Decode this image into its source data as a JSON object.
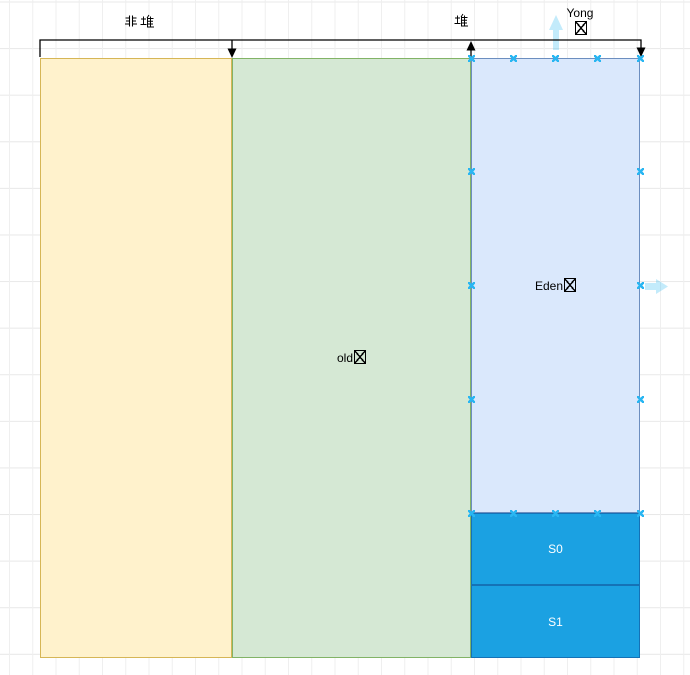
{
  "bracket": {
    "non_heap_label": "非堆",
    "heap_label": "堆",
    "young_label": "Yong区"
  },
  "regions": {
    "non_heap": {
      "fill": "#FFF2CC",
      "border": "#D6B656"
    },
    "old": {
      "label": "old区",
      "fill": "#D5E8D4",
      "border": "#82B366"
    },
    "eden": {
      "label": "Eden区",
      "fill": "#DAE8FC",
      "border": "#6C8EBF"
    },
    "s0": {
      "label": "S0",
      "fill": "#1BA1E2",
      "border": "#1572B6",
      "text_color": "#FFFFFF"
    },
    "s1": {
      "label": "S1",
      "fill": "#1BA1E2",
      "border": "#1572B6",
      "text_color": "#FFFFFF"
    }
  },
  "editor": {
    "connection_point_color": "#29B6F2",
    "hover_arrow_color": "#29B6F2",
    "edge_color": "#000000",
    "grid_line_color": "#E8E8E8"
  }
}
